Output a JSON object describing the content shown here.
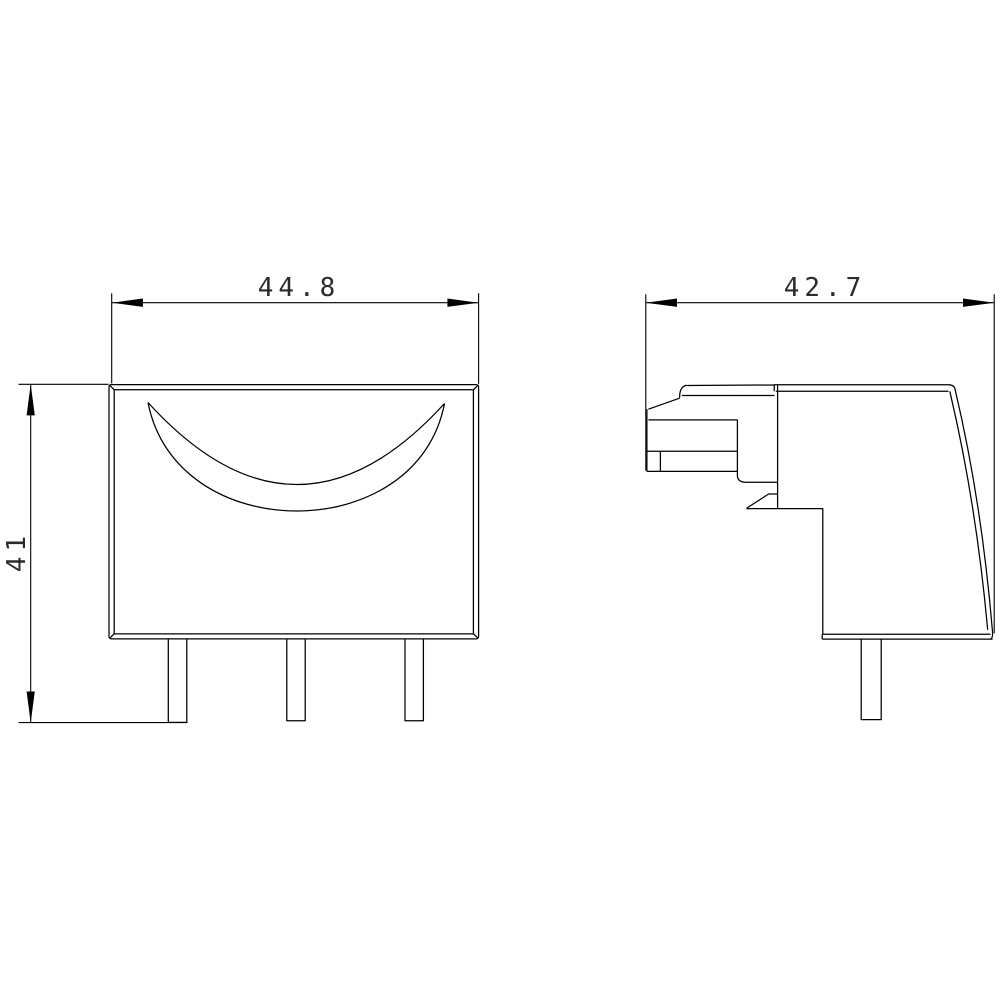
{
  "page": {
    "background": "#ffffff"
  },
  "colors": {
    "line": "#000000",
    "dimension_text": "#2b2b2b"
  },
  "dimensions": {
    "front_width": "44.8",
    "front_height": "41",
    "side_width": "42.7"
  }
}
